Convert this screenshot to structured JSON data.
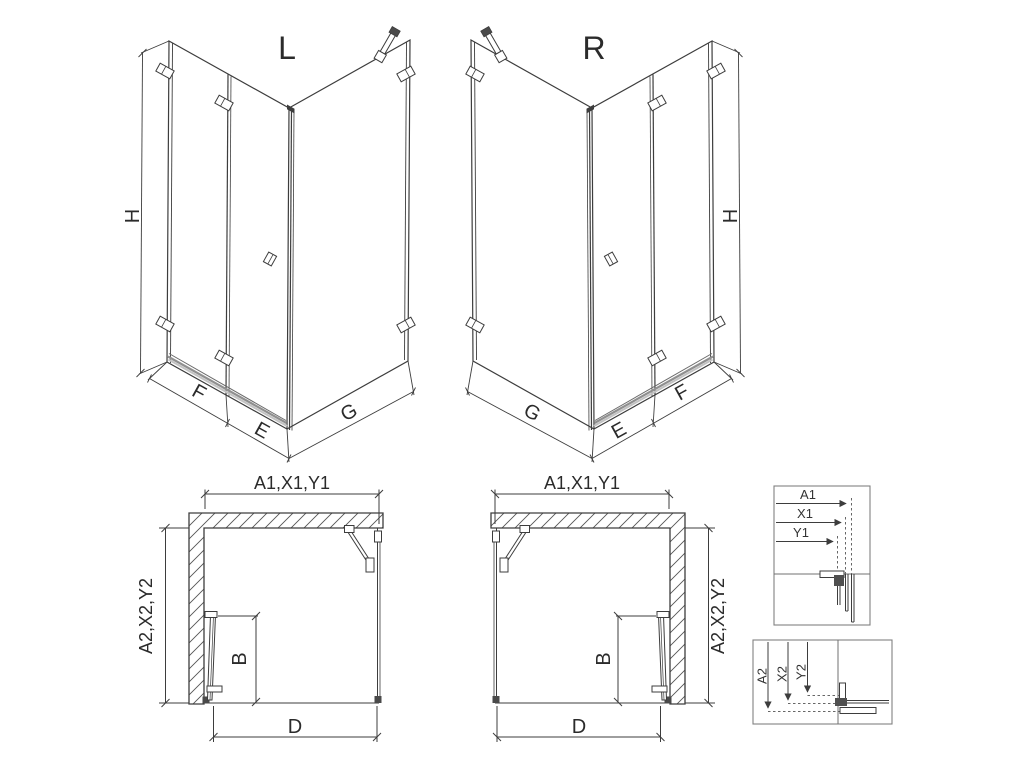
{
  "drawing": {
    "background": "#ffffff",
    "line_color": "#3d3d3d",
    "views": {
      "iso_left": {
        "variant": "L",
        "dim_height": "H",
        "dim_front": "F",
        "dim_door": "E",
        "dim_side": "G"
      },
      "iso_right": {
        "variant": "R",
        "dim_height": "H",
        "dim_front": "F",
        "dim_door": "E",
        "dim_side": "G"
      },
      "plan_left": {
        "dim_width": "A1,X1,Y1",
        "dim_depth": "A2,X2,Y2",
        "dim_door": "B",
        "dim_entry": "D"
      },
      "plan_right": {
        "dim_width": "A1,X1,Y1",
        "dim_depth": "A2,X2,Y2",
        "dim_door": "B",
        "dim_entry": "D"
      },
      "detail_width": {
        "dim_a": "A1",
        "dim_x": "X1",
        "dim_y": "Y1"
      },
      "detail_depth": {
        "dim_a": "A2",
        "dim_x": "X2",
        "dim_y": "Y2"
      }
    }
  }
}
